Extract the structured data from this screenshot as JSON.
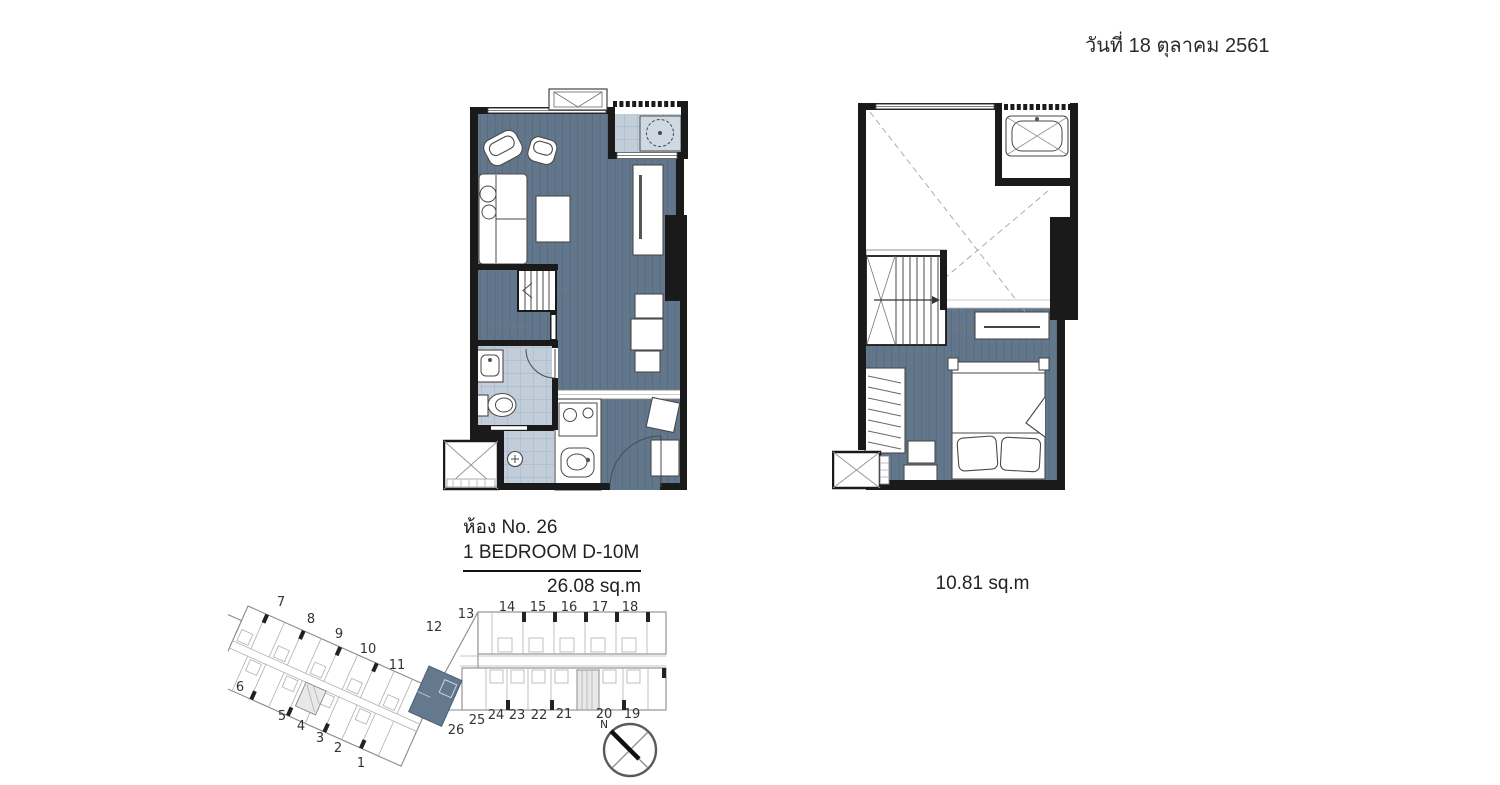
{
  "header": {
    "date": "วันที่ 18 ตุลาคม 2561"
  },
  "unit": {
    "room_no": "ห้อง No. 26",
    "type": "1 BEDROOM D-10M",
    "area_lower": "26.08 sq.m",
    "area_upper": "10.81 sq.m"
  },
  "lower_plan": {
    "up": "UP",
    "storage": "STORAGE"
  },
  "upper_plan": {
    "down": "DOWN"
  },
  "siteplan": {
    "highlighted_unit": "26",
    "compass_north": "N",
    "left_top": [
      "7",
      "8",
      "9",
      "10",
      "11"
    ],
    "left_side": "6",
    "left_bottom": [
      "5",
      "4",
      "3",
      "2",
      "1"
    ],
    "right_top": [
      "12",
      "13",
      "14",
      "15",
      "16",
      "17",
      "18"
    ],
    "right_bottom": [
      "26",
      "25",
      "24",
      "23",
      "22",
      "21",
      "20",
      "19"
    ]
  },
  "colors": {
    "floor_plank": "#63778c",
    "bath_tile": "#c2cdda",
    "wall": "#1a1a1a",
    "highlight_unit": "#64788e"
  }
}
